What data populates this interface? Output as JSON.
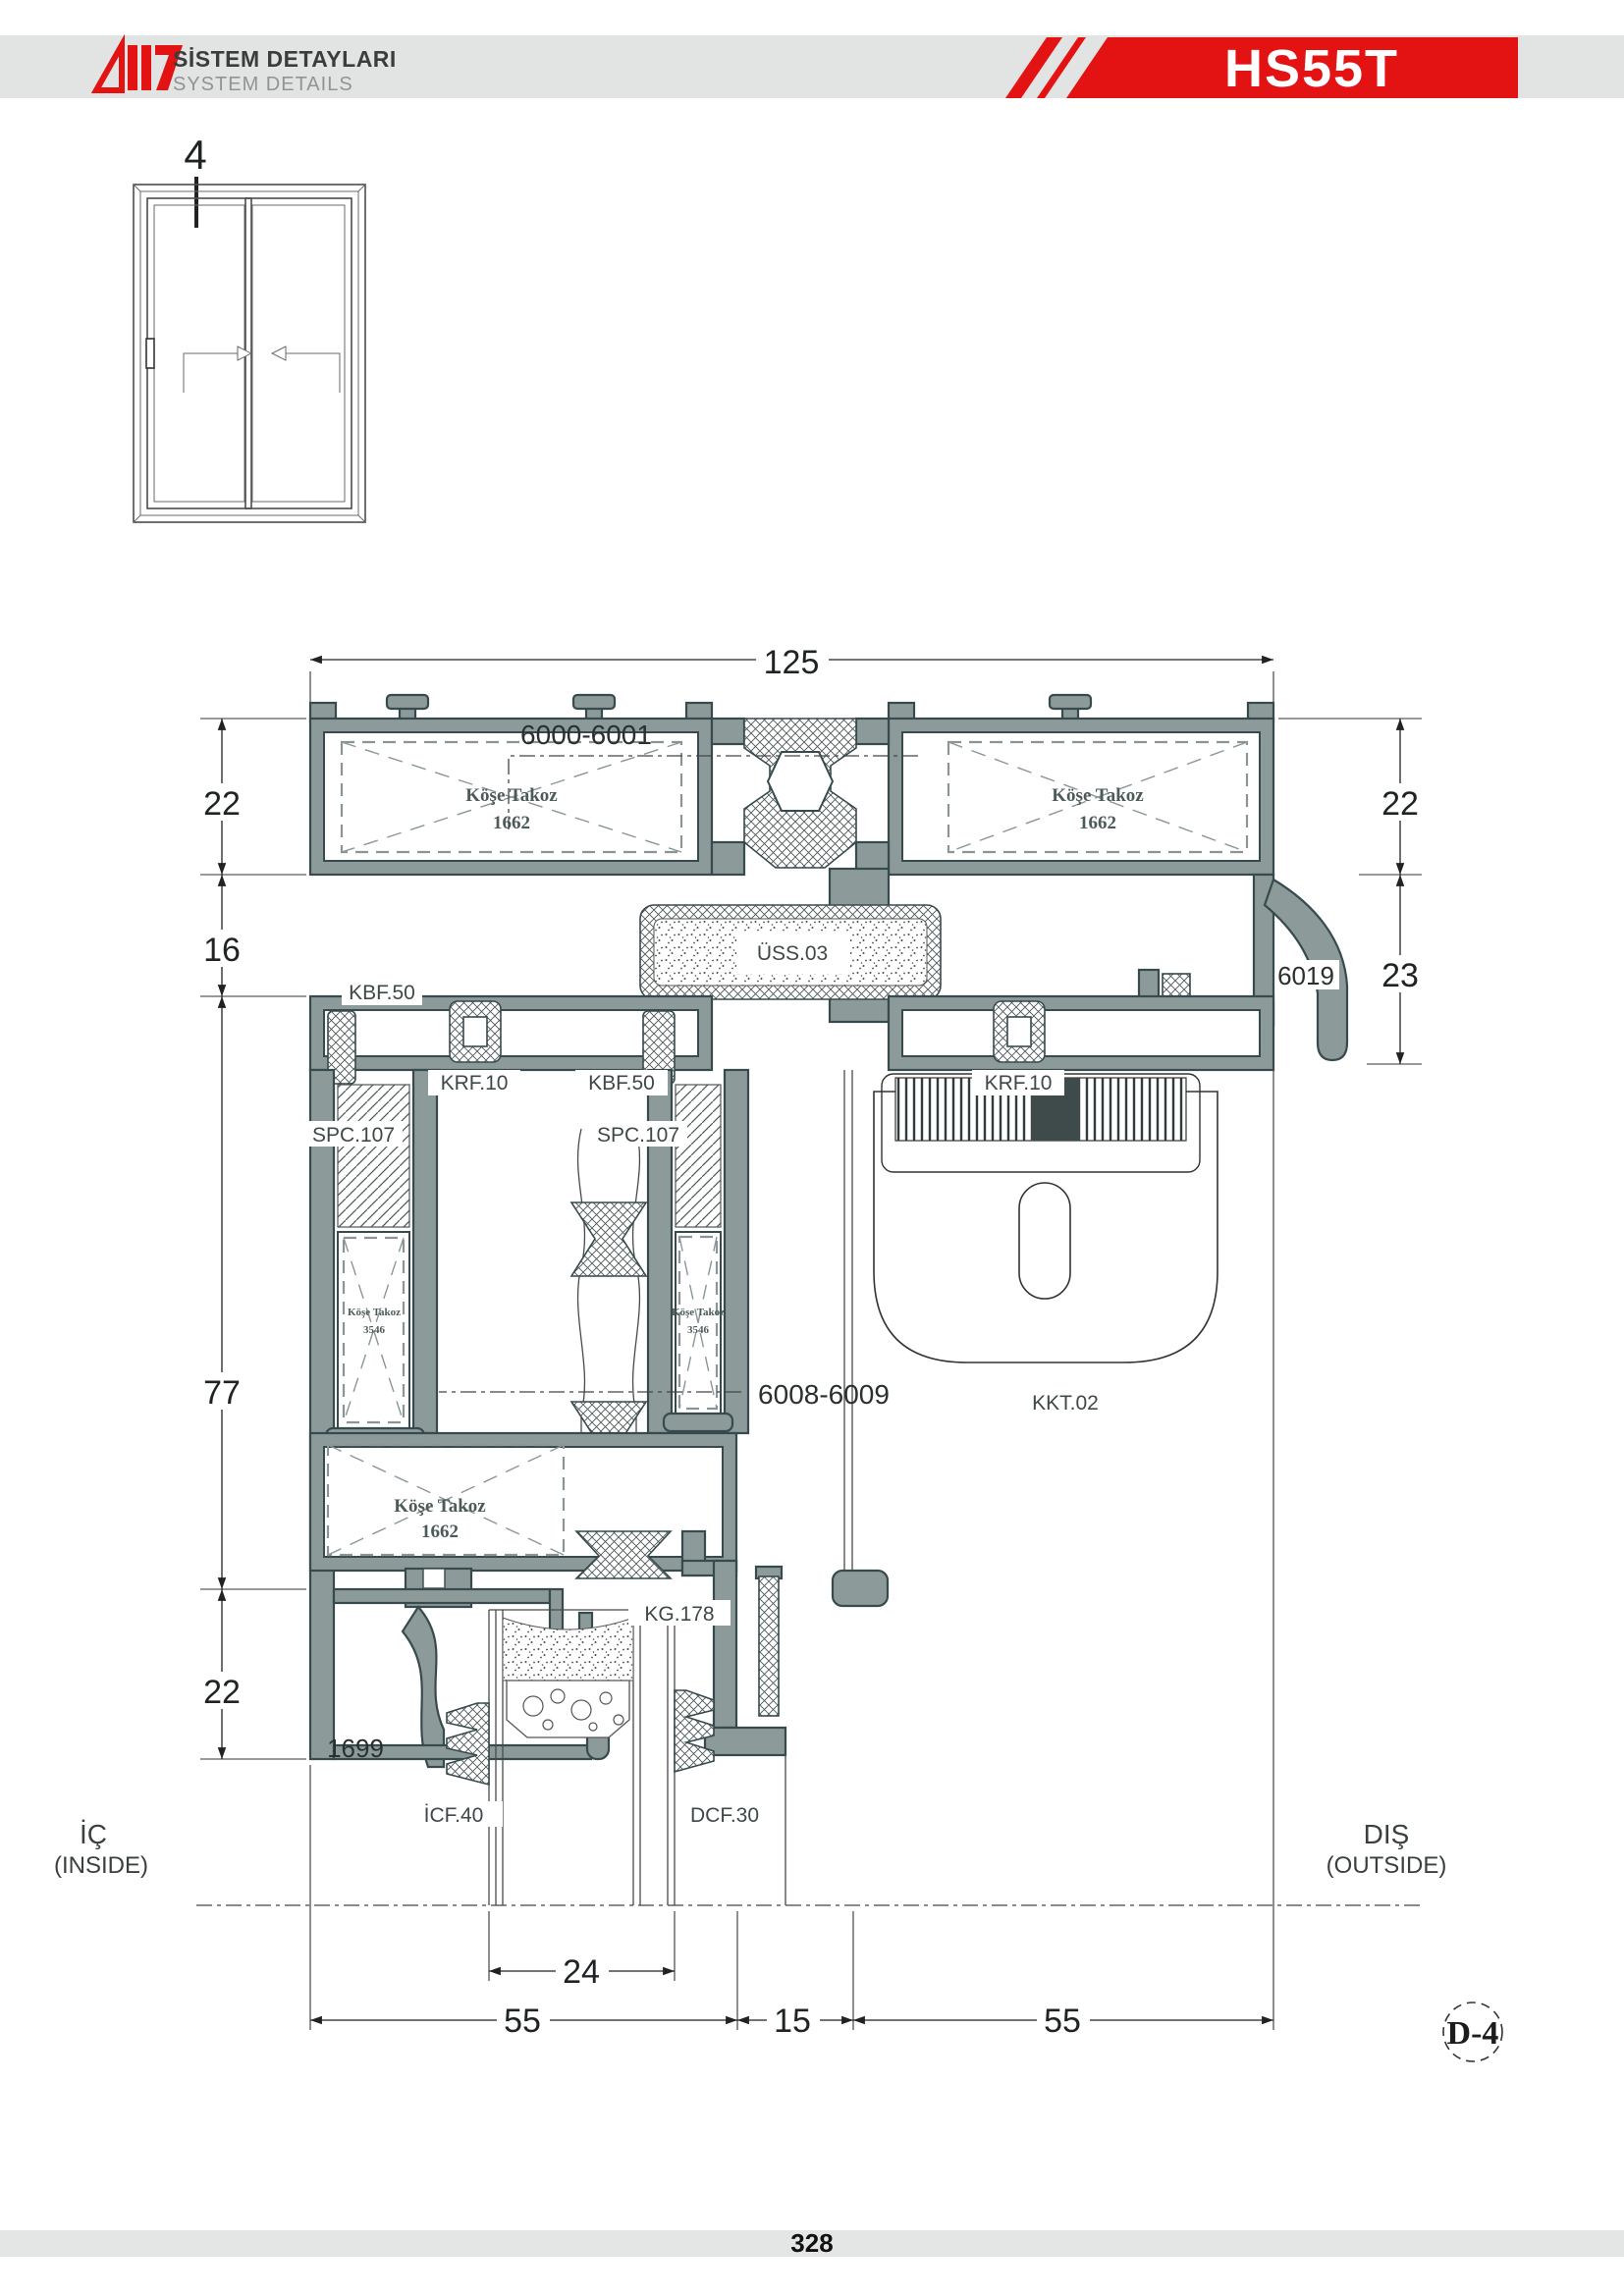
{
  "header": {
    "logo_title": "SİSTEM DETAYLARI",
    "logo_subtitle": "SYSTEM DETAILS",
    "product_code": "HS55T"
  },
  "elevation": {
    "section_mark": "4"
  },
  "dimensions": {
    "overall_width": "125",
    "left_chain": [
      "22",
      "16",
      "77",
      "22"
    ],
    "right_chain": [
      "22",
      "23"
    ],
    "glass_width": "24",
    "bottom_chain": [
      "55",
      "15",
      "55"
    ]
  },
  "parts": {
    "head_profiles": "6000-6001",
    "sash_profiles": "6008-6009",
    "corner_block": "Köşe Takoz",
    "corner_block_1662": "1662",
    "corner_block_3546": "3546",
    "uss03": "ÜSS.03",
    "kbf50": "KBF.50",
    "krf10": "KRF.10",
    "spc107": "SPC.107",
    "p6019": "6019",
    "kkt02": "KKT.02",
    "kg178": "KG.178",
    "p1699": "1699",
    "icf40": "İCF.40",
    "dcf30": "DCF.30"
  },
  "sides": {
    "inside_tr": "İÇ",
    "inside_en": "(INSIDE)",
    "outside_tr": "DIŞ",
    "outside_en": "(OUTSIDE)"
  },
  "detail_ref": "D-4",
  "footer": {
    "page_number": "328"
  },
  "colors": {
    "accent_red": "#e31313",
    "profile_fill": "#8c9b9a",
    "outline": "#374a4d",
    "header_band": "#e2e4e4"
  }
}
